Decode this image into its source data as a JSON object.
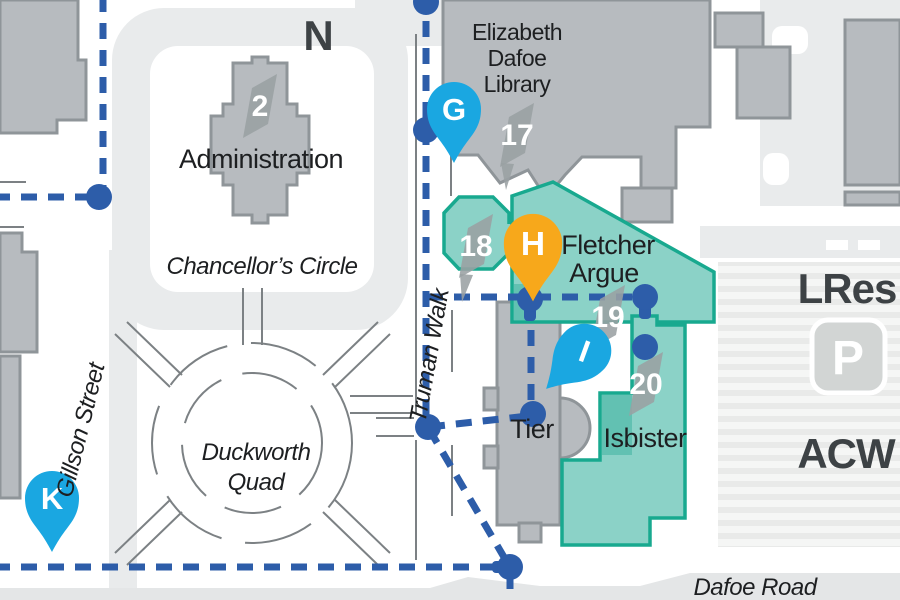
{
  "map": {
    "region_labels": {
      "north_indicator": "N",
      "lres": "LRes",
      "acw": "ACW",
      "parking": "P"
    },
    "streets": {
      "gillson": "Gillson Street",
      "truman": "Truman Walk",
      "dafoe": "Dafoe Road",
      "chancellors": "Chancellor’s Circle"
    },
    "places": {
      "admin": "Administration",
      "library_line1": "Elizabeth",
      "library_line2": "Dafoe",
      "library_line3": "Library",
      "fletcher_line1": "Fletcher",
      "fletcher_line2": "Argue",
      "tier": "Tier",
      "isbister": "Isbister",
      "quad_line1": "Duckworth",
      "quad_line2": "Quad"
    },
    "building_markers": {
      "admin": "2",
      "library": "17",
      "college": "18",
      "fletcher": "19",
      "isbister": "20"
    },
    "pins": {
      "g": "G",
      "h": "H",
      "i": "I",
      "k": "K"
    },
    "colors": {
      "road_gray": "#e9ebec",
      "building_gray": "#b7bbbf",
      "building_stroke": "#8f9599",
      "teal_fill": "#8bd2c7",
      "teal_stroke": "#18a98f",
      "teal_shade": "#62c1b2",
      "marker_gray": "#9aa0a3",
      "path_blue": "#2d5da9",
      "pin_blue": "#1aa7e1",
      "pin_yellow": "#f7a81b",
      "walk_gray": "#7c8184",
      "text_dark": "#1d1f21"
    }
  }
}
